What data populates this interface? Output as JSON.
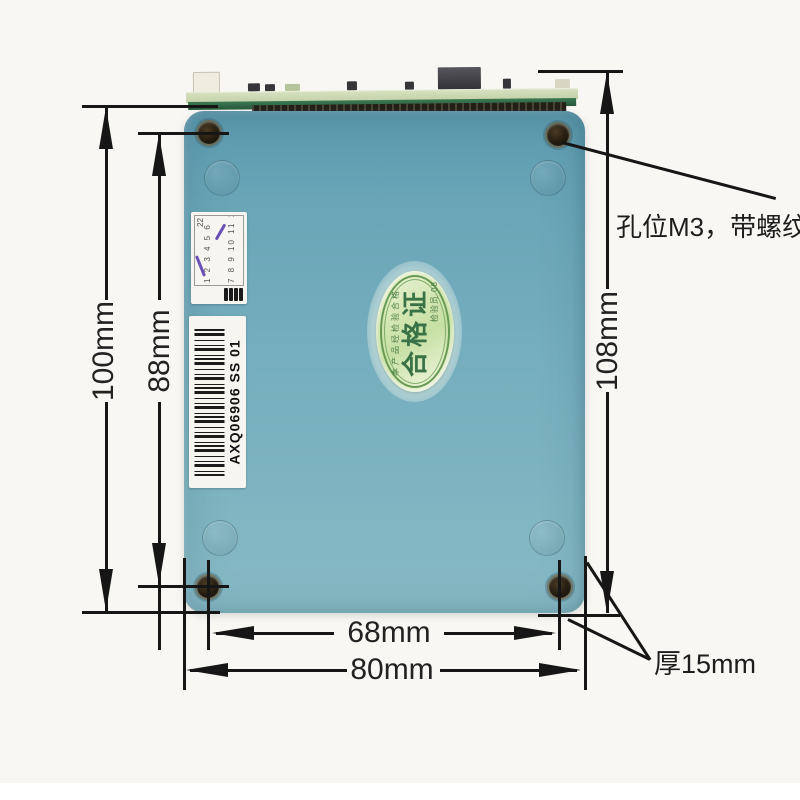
{
  "dimensions": {
    "outer_height": "100mm",
    "hole_span_height": "88mm",
    "right_height": "108mm",
    "hole_span_width": "68mm",
    "outer_width": "80mm"
  },
  "annotations": {
    "hole_note": "孔位M3，带螺纹",
    "thickness_note": "厚15mm"
  },
  "device": {
    "seal": {
      "title": "合格证",
      "arc_text": "本产品经检验合格",
      "inspector": "检验员 08"
    },
    "barcode_label": "AXQ06906 SS 01",
    "qc_sticker": {
      "mark": "22",
      "row1": "1 2 3 4 5 6",
      "row2": "7 8 9 10 11 12"
    }
  },
  "colors": {
    "background": "#f9f7f3",
    "case_teal": "#74adbd",
    "pcb_green": "#2e6b44",
    "seal_green": "#679a52",
    "dimension_line": "#161616"
  }
}
